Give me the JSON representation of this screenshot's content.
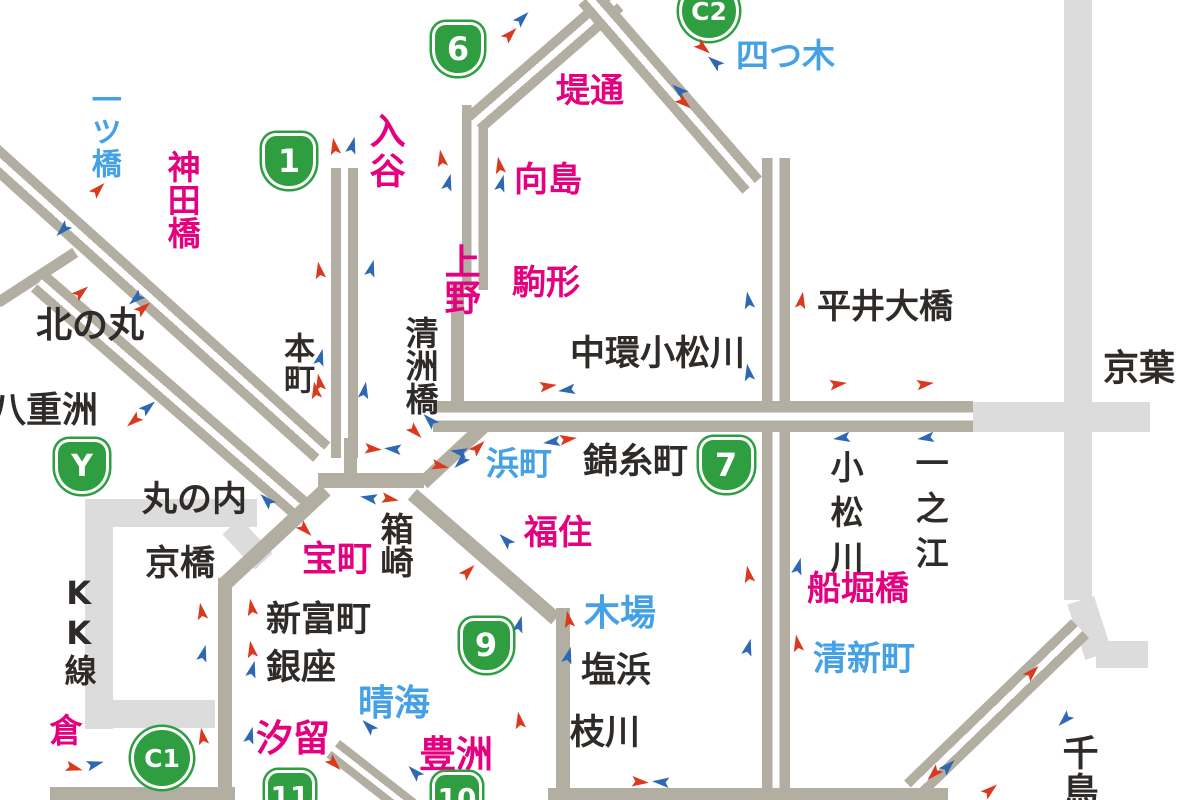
{
  "map": {
    "title": "shutoko-traffic-map",
    "colors": {
      "road_dark": "#b3aea2",
      "road_light": "#dcdcdc",
      "badge_green": "#2f9e41",
      "label_pink": "#e5007f",
      "label_blue": "#45a1e5",
      "label_black": "#2f2b28",
      "arrow_red": "#d93a1e",
      "arrow_blue": "#2e68b2",
      "background": "#ffffff"
    },
    "badges": [
      {
        "t": "1",
        "shape": "shield",
        "x": 289,
        "y": 161,
        "w": 54,
        "h": 56,
        "fs": 32
      },
      {
        "t": "6",
        "shape": "shield",
        "x": 458,
        "y": 49,
        "w": 52,
        "h": 54,
        "fs": 32
      },
      {
        "t": "C2",
        "shape": "circle",
        "x": 709,
        "y": 11,
        "w": 60,
        "h": 60,
        "fs": 25
      },
      {
        "t": "Y",
        "shape": "shield",
        "x": 82,
        "y": 466,
        "w": 54,
        "h": 55,
        "fs": 30
      },
      {
        "t": "7",
        "shape": "shield",
        "x": 726,
        "y": 465,
        "w": 55,
        "h": 56,
        "fs": 32
      },
      {
        "t": "9",
        "shape": "shield",
        "x": 486,
        "y": 645,
        "w": 53,
        "h": 55,
        "fs": 32
      },
      {
        "t": "C1",
        "shape": "circle",
        "x": 162,
        "y": 758,
        "w": 62,
        "h": 62,
        "fs": 25
      },
      {
        "t": "11",
        "shape": "shield",
        "x": 290,
        "y": 796,
        "w": 50,
        "h": 52,
        "fs": 28
      },
      {
        "t": "10",
        "shape": "shield",
        "x": 457,
        "y": 798,
        "w": 50,
        "h": 52,
        "fs": 28
      }
    ],
    "labels": [
      {
        "t": "一ツ橋",
        "c": "blue",
        "x": 104,
        "y": 84,
        "o": "v",
        "s": 30,
        "sp": 2
      },
      {
        "t": "神田橋",
        "c": "pink",
        "x": 182,
        "y": 150,
        "o": "v",
        "s": 33,
        "sp": 0
      },
      {
        "t": "入谷",
        "c": "pink",
        "x": 385,
        "y": 112,
        "o": "v",
        "s": 36,
        "sp": 4
      },
      {
        "t": "上野",
        "c": "pink",
        "x": 460,
        "y": 243,
        "o": "v",
        "s": 36,
        "sp": 0
      },
      {
        "t": "堤通",
        "c": "pink",
        "x": 556,
        "y": 74,
        "o": "h",
        "s": 34
      },
      {
        "t": "向島",
        "c": "pink",
        "x": 514,
        "y": 163,
        "o": "h",
        "s": 34
      },
      {
        "t": "駒形",
        "c": "pink",
        "x": 512,
        "y": 266,
        "o": "h",
        "s": 34
      },
      {
        "t": "四つ木",
        "c": "blue",
        "x": 736,
        "y": 39,
        "o": "h",
        "s": 33
      },
      {
        "t": "平井大橋",
        "c": "black",
        "x": 817,
        "y": 290,
        "o": "h",
        "s": 34
      },
      {
        "t": "中環小松川",
        "c": "black",
        "x": 570,
        "y": 336,
        "o": "h",
        "s": 35
      },
      {
        "t": "北の丸",
        "c": "black",
        "x": 36,
        "y": 307,
        "o": "h",
        "s": 36
      },
      {
        "t": "八重洲",
        "c": "black",
        "x": -10,
        "y": 392,
        "o": "h",
        "s": 36
      },
      {
        "t": "本町",
        "c": "black",
        "x": 297,
        "y": 332,
        "o": "v",
        "s": 31,
        "sp": 0
      },
      {
        "t": "清洲橋",
        "c": "black",
        "x": 420,
        "y": 316,
        "o": "v",
        "s": 33,
        "sp": 0
      },
      {
        "t": "錦糸町",
        "c": "black",
        "x": 583,
        "y": 444,
        "o": "h",
        "s": 35
      },
      {
        "t": "浜町",
        "c": "blue",
        "x": 486,
        "y": 447,
        "o": "h",
        "s": 33
      },
      {
        "t": "京葉",
        "c": "black",
        "x": 1103,
        "y": 350,
        "o": "h",
        "s": 36
      },
      {
        "t": "小松川",
        "c": "black",
        "x": 845,
        "y": 450,
        "o": "v",
        "s": 33,
        "sp": 12
      },
      {
        "t": "一之江",
        "c": "black",
        "x": 930,
        "y": 446,
        "o": "v",
        "s": 33,
        "sp": 12
      },
      {
        "t": "丸の内",
        "c": "black",
        "x": 142,
        "y": 482,
        "o": "h",
        "s": 35
      },
      {
        "t": "京橋",
        "c": "black",
        "x": 145,
        "y": 546,
        "o": "h",
        "s": 35
      },
      {
        "t": "宝町",
        "c": "pink",
        "x": 302,
        "y": 542,
        "o": "h",
        "s": 35
      },
      {
        "t": "箱崎",
        "c": "black",
        "x": 395,
        "y": 512,
        "o": "v",
        "s": 33,
        "sp": 0
      },
      {
        "t": "KK線",
        "c": "black",
        "x": 79,
        "y": 574,
        "o": "v",
        "s": 32,
        "sp": 2
      },
      {
        "t": "新富町",
        "c": "black",
        "x": 266,
        "y": 602,
        "o": "h",
        "s": 35
      },
      {
        "t": "銀座",
        "c": "black",
        "x": 266,
        "y": 650,
        "o": "h",
        "s": 35
      },
      {
        "t": "福住",
        "c": "pink",
        "x": 524,
        "y": 516,
        "o": "h",
        "s": 34
      },
      {
        "t": "木場",
        "c": "blue",
        "x": 584,
        "y": 595,
        "o": "h",
        "s": 36
      },
      {
        "t": "塩浜",
        "c": "black",
        "x": 581,
        "y": 653,
        "o": "h",
        "s": 35
      },
      {
        "t": "枝川",
        "c": "black",
        "x": 570,
        "y": 715,
        "o": "h",
        "s": 35
      },
      {
        "t": "晴海",
        "c": "blue",
        "x": 358,
        "y": 685,
        "o": "h",
        "s": 36
      },
      {
        "t": "汐留",
        "c": "pink",
        "x": 256,
        "y": 720,
        "o": "h",
        "s": 37
      },
      {
        "t": "豊洲",
        "c": "pink",
        "x": 419,
        "y": 736,
        "o": "h",
        "s": 37
      },
      {
        "t": "船堀橋",
        "c": "pink",
        "x": 807,
        "y": 572,
        "o": "h",
        "s": 34
      },
      {
        "t": "清新町",
        "c": "blue",
        "x": 813,
        "y": 642,
        "o": "h",
        "s": 34
      },
      {
        "t": "千鳥",
        "c": "black",
        "x": 1078,
        "y": 734,
        "o": "v",
        "s": 36,
        "sp": 2
      },
      {
        "t": "倉",
        "c": "pink",
        "x": 64,
        "y": 713,
        "o": "v",
        "s": 33,
        "sp": 0
      }
    ],
    "roads": [
      {
        "x": -30,
        "y": 118,
        "l": 485,
        "t": 26,
        "r": 42,
        "st": "dual",
        "sh": "d"
      },
      {
        "x": -5,
        "y": 298,
        "l": 92,
        "t": 11,
        "r": -33,
        "st": "s",
        "sh": "d"
      },
      {
        "x": 48,
        "y": 272,
        "l": 352,
        "t": 26,
        "r": 41,
        "st": "dual",
        "sh": "d"
      },
      {
        "x": 85,
        "y": 499,
        "l": 172,
        "t": 28,
        "r": 0,
        "st": "s",
        "sh": "l"
      },
      {
        "x": 113,
        "y": 499,
        "l": 230,
        "t": 28,
        "r": 90,
        "st": "s",
        "sh": "l"
      },
      {
        "x": 85,
        "y": 700,
        "l": 130,
        "t": 28,
        "r": 0,
        "st": "s",
        "sh": "l"
      },
      {
        "x": 240,
        "y": 518,
        "l": 48,
        "t": 24,
        "r": 47,
        "st": "s",
        "sh": "l"
      },
      {
        "x": 973,
        "y": 402,
        "l": 177,
        "t": 30,
        "r": 0,
        "st": "s",
        "sh": "l"
      },
      {
        "x": 1092,
        "y": 0,
        "l": 600,
        "t": 28,
        "r": 90,
        "st": "s",
        "sh": "l"
      },
      {
        "x": 1094,
        "y": 596,
        "l": 58,
        "t": 28,
        "r": 72,
        "st": "s",
        "sh": "l"
      },
      {
        "x": 1096,
        "y": 641,
        "l": 52,
        "t": 27,
        "r": 0,
        "st": "s",
        "sh": "l"
      },
      {
        "x": 358,
        "y": 168,
        "l": 290,
        "t": 27,
        "r": 90,
        "st": "dual",
        "sh": "d"
      },
      {
        "x": 488,
        "y": 105,
        "l": 185,
        "t": 26,
        "r": 90,
        "st": "dual",
        "sh": "d"
      },
      {
        "x": 464,
        "y": 285,
        "l": 132,
        "t": 13,
        "r": 90,
        "st": "s",
        "sh": "d"
      },
      {
        "x": 418,
        "y": 478,
        "l": 99,
        "t": 14,
        "r": -43,
        "st": "s",
        "sh": "d"
      },
      {
        "x": 318,
        "y": 473,
        "l": 106,
        "t": 15,
        "r": 0,
        "st": "s",
        "sh": "d"
      },
      {
        "x": 357,
        "y": 438,
        "l": 38,
        "t": 13,
        "r": 90,
        "st": "s",
        "sh": "d"
      },
      {
        "x": 466,
        "y": 113,
        "l": 186,
        "t": 26,
        "r": -41,
        "st": "dual",
        "sh": "d"
      },
      {
        "x": 598,
        "y": -12,
        "l": 250,
        "t": 26,
        "r": 49,
        "st": "dual",
        "sh": "d"
      },
      {
        "x": 790,
        "y": 158,
        "l": 646,
        "t": 28,
        "r": 90,
        "st": "dual",
        "sh": "d"
      },
      {
        "x": 433,
        "y": 401,
        "l": 540,
        "t": 31,
        "r": 0,
        "st": "dual",
        "sh": "d"
      },
      {
        "x": 1089,
        "y": 638,
        "l": 232,
        "t": 26,
        "r": 136,
        "st": "dual",
        "sh": "d"
      },
      {
        "x": 548,
        "y": 788,
        "l": 400,
        "t": 15,
        "r": 0,
        "st": "s",
        "sh": "d"
      },
      {
        "x": 417,
        "y": 489,
        "l": 190,
        "t": 14,
        "r": 41,
        "st": "s",
        "sh": "d"
      },
      {
        "x": 570,
        "y": 608,
        "l": 186,
        "t": 14,
        "r": 90,
        "st": "s",
        "sh": "d"
      },
      {
        "x": 218,
        "y": 580,
        "l": 140,
        "t": 15,
        "r": -43,
        "st": "s",
        "sh": "d"
      },
      {
        "x": 232,
        "y": 578,
        "l": 216,
        "t": 14,
        "r": 90,
        "st": "s",
        "sh": "d"
      },
      {
        "x": 50,
        "y": 787,
        "l": 185,
        "t": 15,
        "r": 0,
        "st": "s",
        "sh": "d"
      },
      {
        "x": 340,
        "y": 740,
        "l": 118,
        "t": 22,
        "r": 38,
        "st": "dual",
        "sh": "d"
      }
    ],
    "arrows": [
      {
        "x": 326,
        "y": 140,
        "c": "red",
        "r": -100
      },
      {
        "x": 344,
        "y": 139,
        "c": "blue",
        "r": -75
      },
      {
        "x": 311,
        "y": 264,
        "c": "red",
        "r": -100
      },
      {
        "x": 363,
        "y": 262,
        "c": "blue",
        "r": -75
      },
      {
        "x": 433,
        "y": 152,
        "c": "red",
        "r": -100
      },
      {
        "x": 440,
        "y": 176,
        "c": "blue",
        "r": -75
      },
      {
        "x": 491,
        "y": 159,
        "c": "red",
        "r": -100
      },
      {
        "x": 493,
        "y": 177,
        "c": "blue",
        "r": -75
      },
      {
        "x": 502,
        "y": 28,
        "c": "red",
        "r": -45
      },
      {
        "x": 514,
        "y": 12,
        "c": "blue",
        "r": -45
      },
      {
        "x": 695,
        "y": 42,
        "c": "red",
        "r": 40
      },
      {
        "x": 706,
        "y": 56,
        "c": "blue",
        "r": -140
      },
      {
        "x": 670,
        "y": 84,
        "c": "blue",
        "r": -140
      },
      {
        "x": 676,
        "y": 97,
        "c": "red",
        "r": 40
      },
      {
        "x": 793,
        "y": 294,
        "c": "red",
        "r": -80
      },
      {
        "x": 740,
        "y": 294,
        "c": "blue",
        "r": -100
      },
      {
        "x": 740,
        "y": 366,
        "c": "blue",
        "r": -100
      },
      {
        "x": 830,
        "y": 378,
        "c": "red",
        "r": -8
      },
      {
        "x": 917,
        "y": 378,
        "c": "red",
        "r": -8
      },
      {
        "x": 833,
        "y": 432,
        "c": "blue",
        "r": 172
      },
      {
        "x": 917,
        "y": 432,
        "c": "blue",
        "r": 172
      },
      {
        "x": 540,
        "y": 380,
        "c": "red",
        "r": -8
      },
      {
        "x": 558,
        "y": 384,
        "c": "blue",
        "r": 172
      },
      {
        "x": 543,
        "y": 436,
        "c": "blue",
        "r": 172
      },
      {
        "x": 560,
        "y": 433,
        "c": "red",
        "r": -8
      },
      {
        "x": 450,
        "y": 446,
        "c": "blue",
        "r": 190
      },
      {
        "x": 432,
        "y": 460,
        "c": "red",
        "r": 12
      },
      {
        "x": 421,
        "y": 414,
        "c": "blue",
        "r": -135
      },
      {
        "x": 407,
        "y": 426,
        "c": "red",
        "r": 45
      },
      {
        "x": 307,
        "y": 384,
        "c": "red",
        "r": -100
      },
      {
        "x": 356,
        "y": 384,
        "c": "blue",
        "r": -80
      },
      {
        "x": 365,
        "y": 443,
        "c": "red",
        "r": 5
      },
      {
        "x": 384,
        "y": 443,
        "c": "blue",
        "r": 185
      },
      {
        "x": 360,
        "y": 492,
        "c": "blue",
        "r": 190
      },
      {
        "x": 382,
        "y": 493,
        "c": "red",
        "r": 10
      },
      {
        "x": 297,
        "y": 524,
        "c": "red",
        "r": 45
      },
      {
        "x": 258,
        "y": 494,
        "c": "blue",
        "r": -135
      },
      {
        "x": 470,
        "y": 441,
        "c": "red",
        "r": -45
      },
      {
        "x": 452,
        "y": 456,
        "c": "blue",
        "r": 135
      },
      {
        "x": 140,
        "y": 401,
        "c": "blue",
        "r": -40
      },
      {
        "x": 125,
        "y": 415,
        "c": "red",
        "r": 140
      },
      {
        "x": 90,
        "y": 183,
        "c": "red",
        "r": -45
      },
      {
        "x": 54,
        "y": 224,
        "c": "blue",
        "r": 135
      },
      {
        "x": 73,
        "y": 286,
        "c": "red",
        "r": -40
      },
      {
        "x": 127,
        "y": 293,
        "c": "blue",
        "r": 140
      },
      {
        "x": 135,
        "y": 302,
        "c": "red",
        "r": -40
      },
      {
        "x": 312,
        "y": 351,
        "c": "blue",
        "r": -75
      },
      {
        "x": 311,
        "y": 376,
        "c": "red",
        "r": -100
      },
      {
        "x": 193,
        "y": 605,
        "c": "red",
        "r": -100
      },
      {
        "x": 195,
        "y": 647,
        "c": "blue",
        "r": -75
      },
      {
        "x": 243,
        "y": 601,
        "c": "red",
        "r": -100
      },
      {
        "x": 243,
        "y": 643,
        "c": "red",
        "r": -100
      },
      {
        "x": 244,
        "y": 663,
        "c": "blue",
        "r": -75
      },
      {
        "x": 194,
        "y": 730,
        "c": "red",
        "r": -100
      },
      {
        "x": 66,
        "y": 762,
        "c": "red",
        "r": 15
      },
      {
        "x": 87,
        "y": 758,
        "c": "blue",
        "r": -15
      },
      {
        "x": 242,
        "y": 729,
        "c": "blue",
        "r": -75
      },
      {
        "x": 326,
        "y": 758,
        "c": "red",
        "r": 45
      },
      {
        "x": 360,
        "y": 720,
        "c": "blue",
        "r": -135
      },
      {
        "x": 406,
        "y": 766,
        "c": "blue",
        "r": -135
      },
      {
        "x": 511,
        "y": 618,
        "c": "blue",
        "r": -75
      },
      {
        "x": 560,
        "y": 613,
        "c": "red",
        "r": -100
      },
      {
        "x": 560,
        "y": 649,
        "c": "blue",
        "r": -75
      },
      {
        "x": 511,
        "y": 714,
        "c": "red",
        "r": -100
      },
      {
        "x": 497,
        "y": 534,
        "c": "blue",
        "r": -135
      },
      {
        "x": 460,
        "y": 565,
        "c": "red",
        "r": -45
      },
      {
        "x": 740,
        "y": 568,
        "c": "red",
        "r": -100
      },
      {
        "x": 790,
        "y": 560,
        "c": "blue",
        "r": -75
      },
      {
        "x": 740,
        "y": 641,
        "c": "blue",
        "r": -75
      },
      {
        "x": 789,
        "y": 637,
        "c": "red",
        "r": -100
      },
      {
        "x": 1024,
        "y": 666,
        "c": "red",
        "r": -45
      },
      {
        "x": 1056,
        "y": 714,
        "c": "blue",
        "r": 135
      },
      {
        "x": 940,
        "y": 760,
        "c": "blue",
        "r": -45
      },
      {
        "x": 925,
        "y": 768,
        "c": "red",
        "r": 135
      },
      {
        "x": 982,
        "y": 784,
        "c": "red",
        "r": -40
      },
      {
        "x": 632,
        "y": 776,
        "c": "red",
        "r": 5
      },
      {
        "x": 652,
        "y": 776,
        "c": "blue",
        "r": 185
      }
    ]
  }
}
